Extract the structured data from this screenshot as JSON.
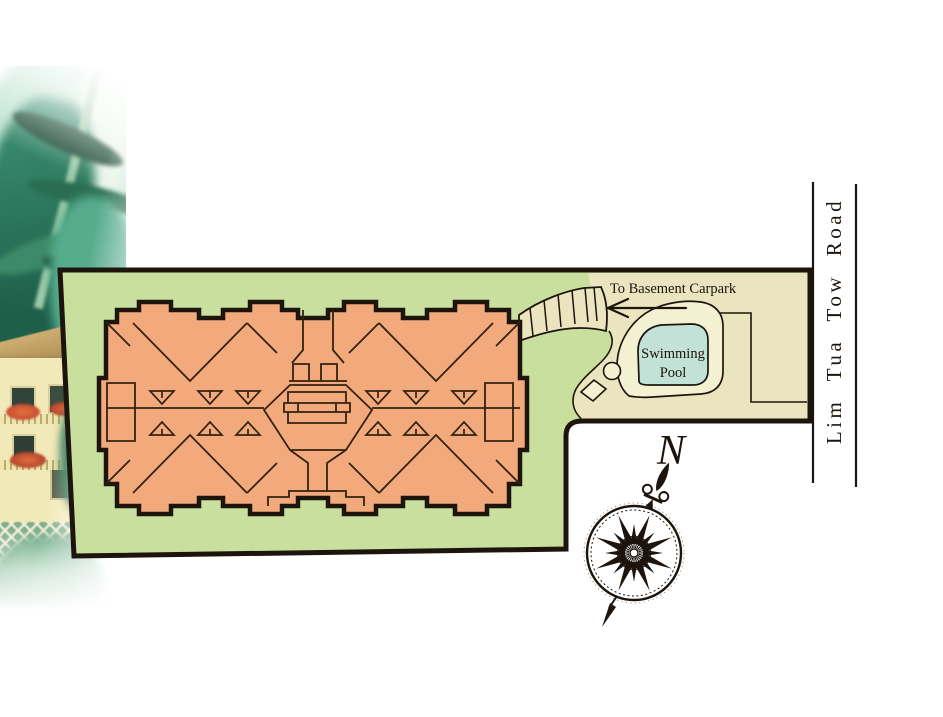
{
  "labels": {
    "road_name": "Lim Tua Tow Road",
    "basement_carpark": "To Basement Carpark",
    "swimming_pool_line1": "Swimming",
    "swimming_pool_line2": "Pool",
    "compass_north": "N"
  },
  "colors": {
    "site-green": "#c8df9e",
    "paving-cream": "#eae5bf",
    "deck-cream": "#f4f0d2",
    "building-salmon": "#f2a97c",
    "pool-teal": "#c2e1d7",
    "ink": "#1d150d",
    "roof-line": "#33220f"
  }
}
